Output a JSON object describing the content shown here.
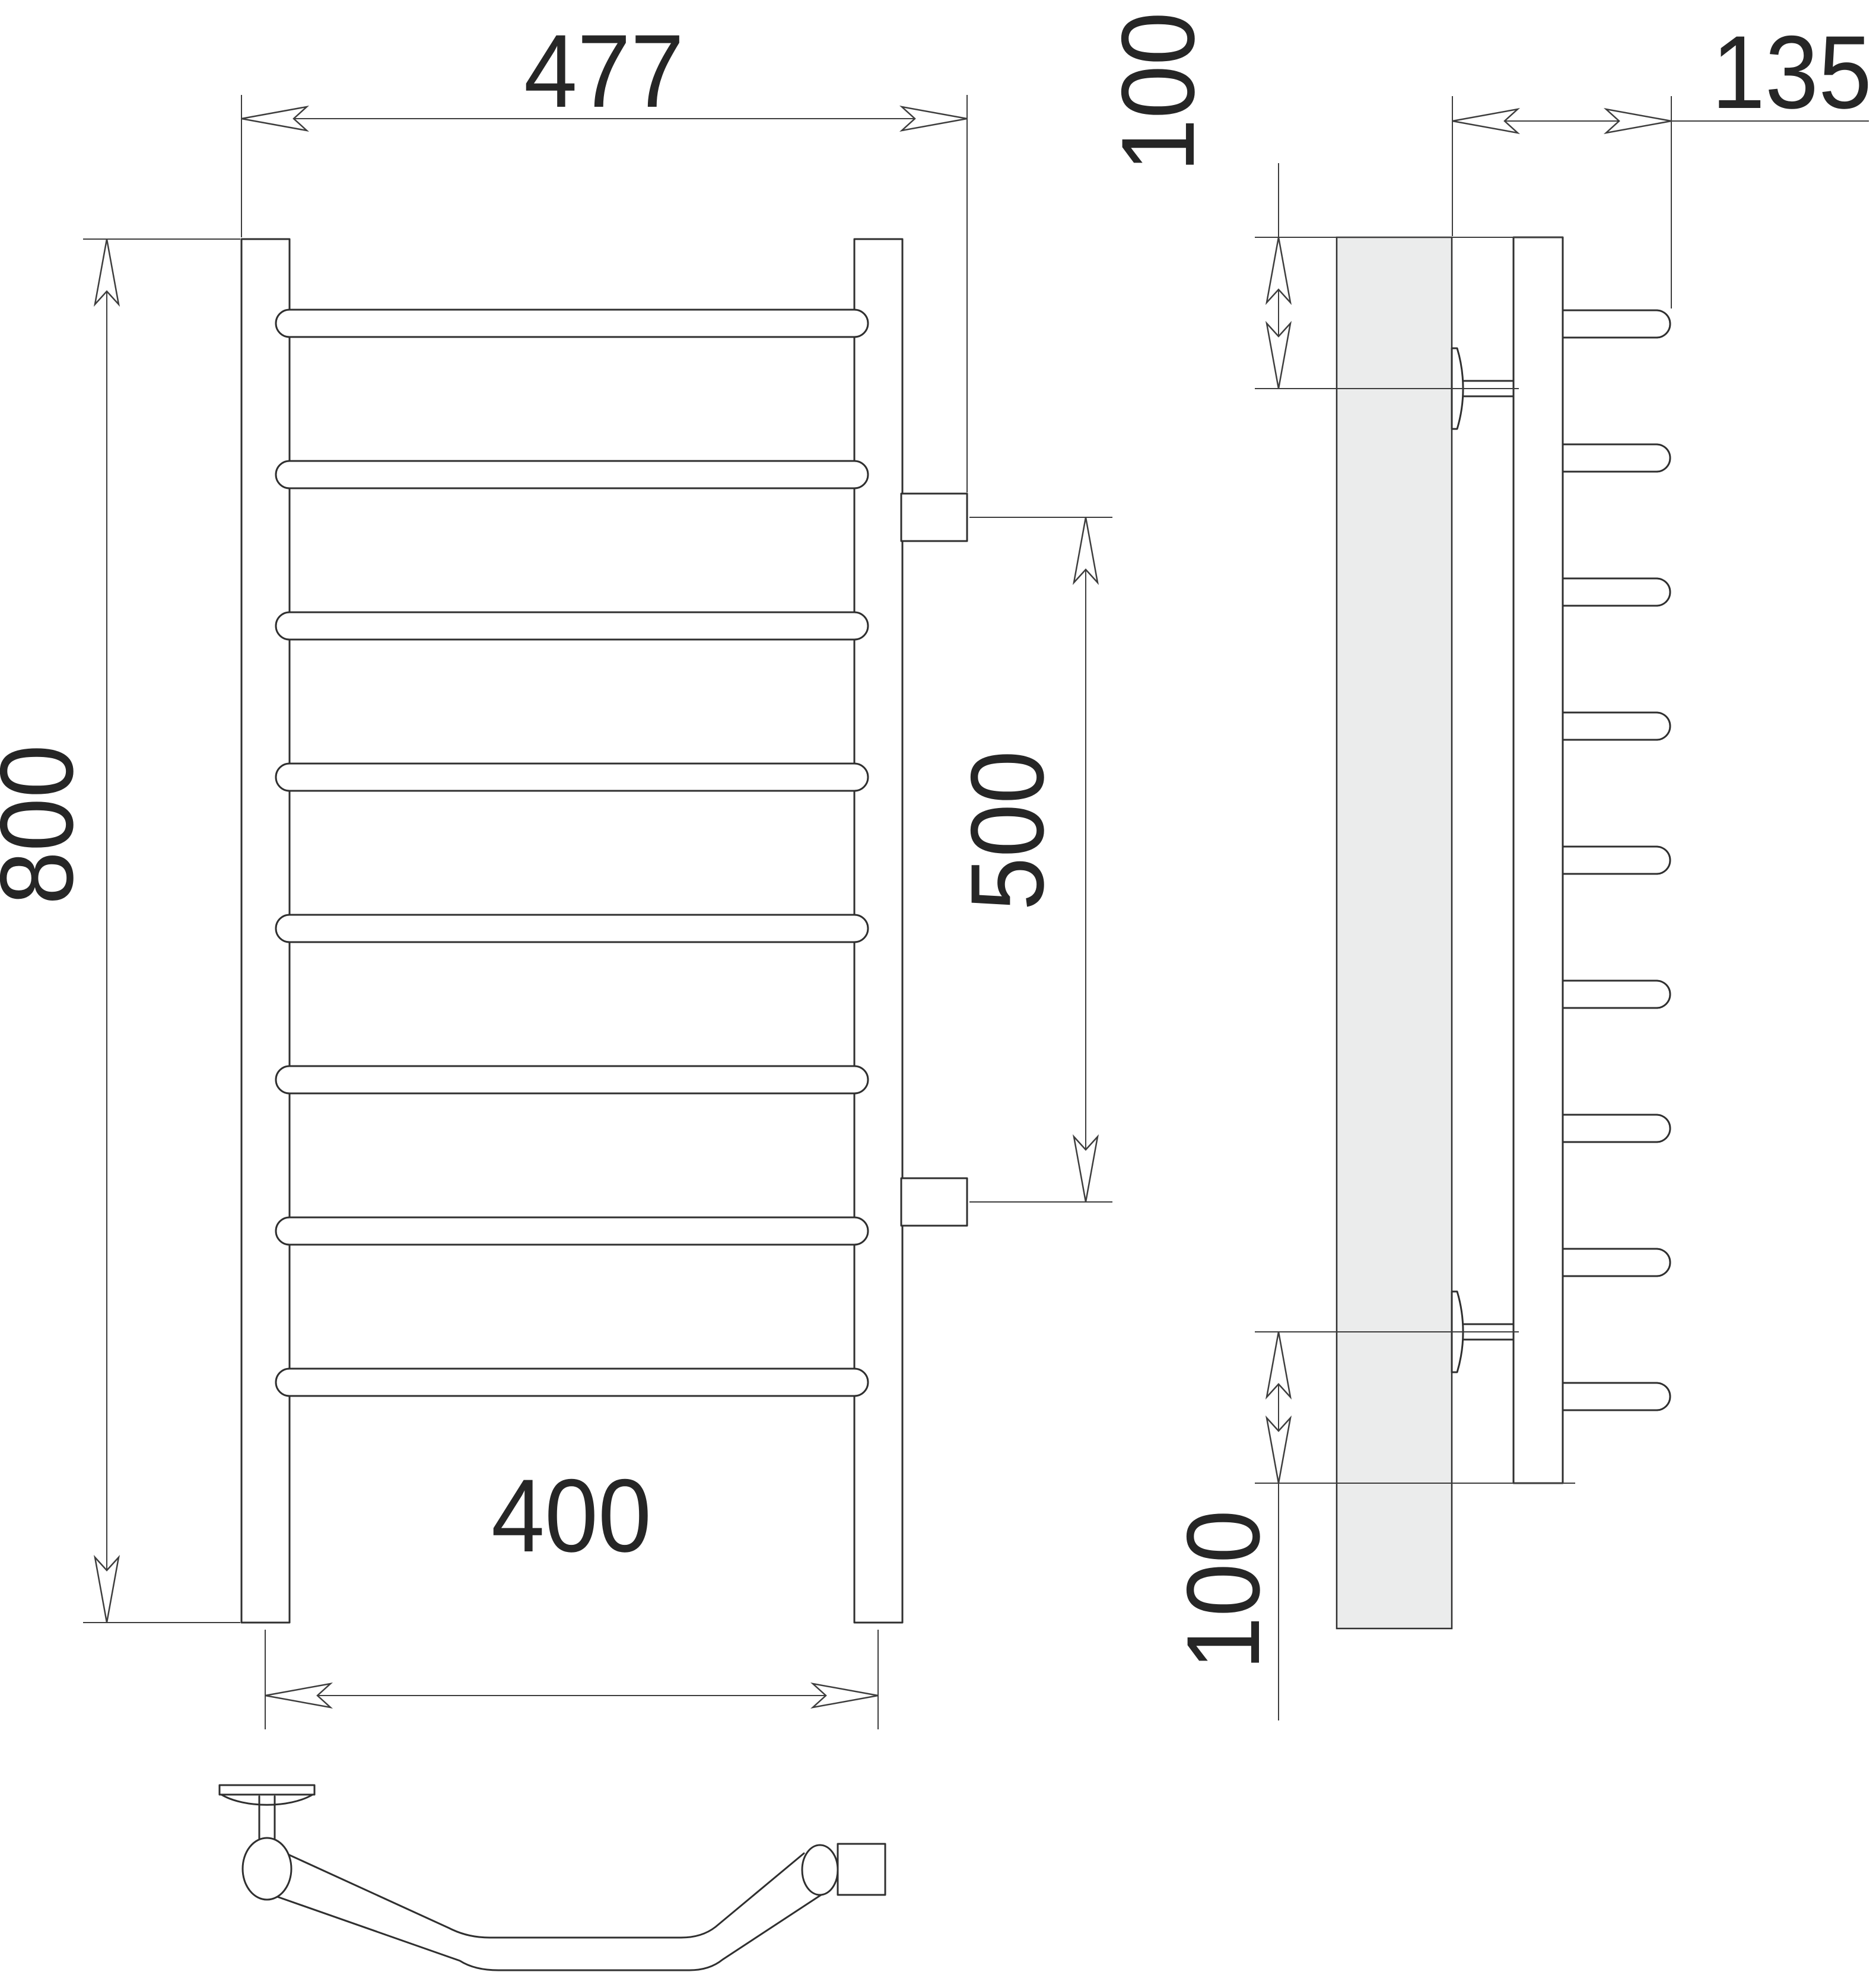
{
  "drawing": {
    "type": "technical dimension drawing",
    "subject": "wall-mounted ladder towel rail, front and side orthographic views with mounting detail",
    "front_view": {
      "label": "front view",
      "rung_count": 8,
      "post_count": 2,
      "connection_stub_count": 2,
      "dim_overall_width": "477",
      "dim_height": "800",
      "dim_mount_width": "400",
      "dim_connection_spacing": "500"
    },
    "side_view": {
      "label": "side view",
      "rung_count": 9,
      "bracket_count": 2,
      "dim_depth": "135",
      "dim_top_offset": "100",
      "dim_bottom_offset": "100"
    },
    "detail_view": {
      "label": "bracket and pipe bend detail"
    },
    "colors": {
      "line": "#2f2f2f",
      "dim": "#3d3d3d",
      "text": "#262626",
      "wall": "#ebecec",
      "bg": "#ffffff"
    }
  }
}
